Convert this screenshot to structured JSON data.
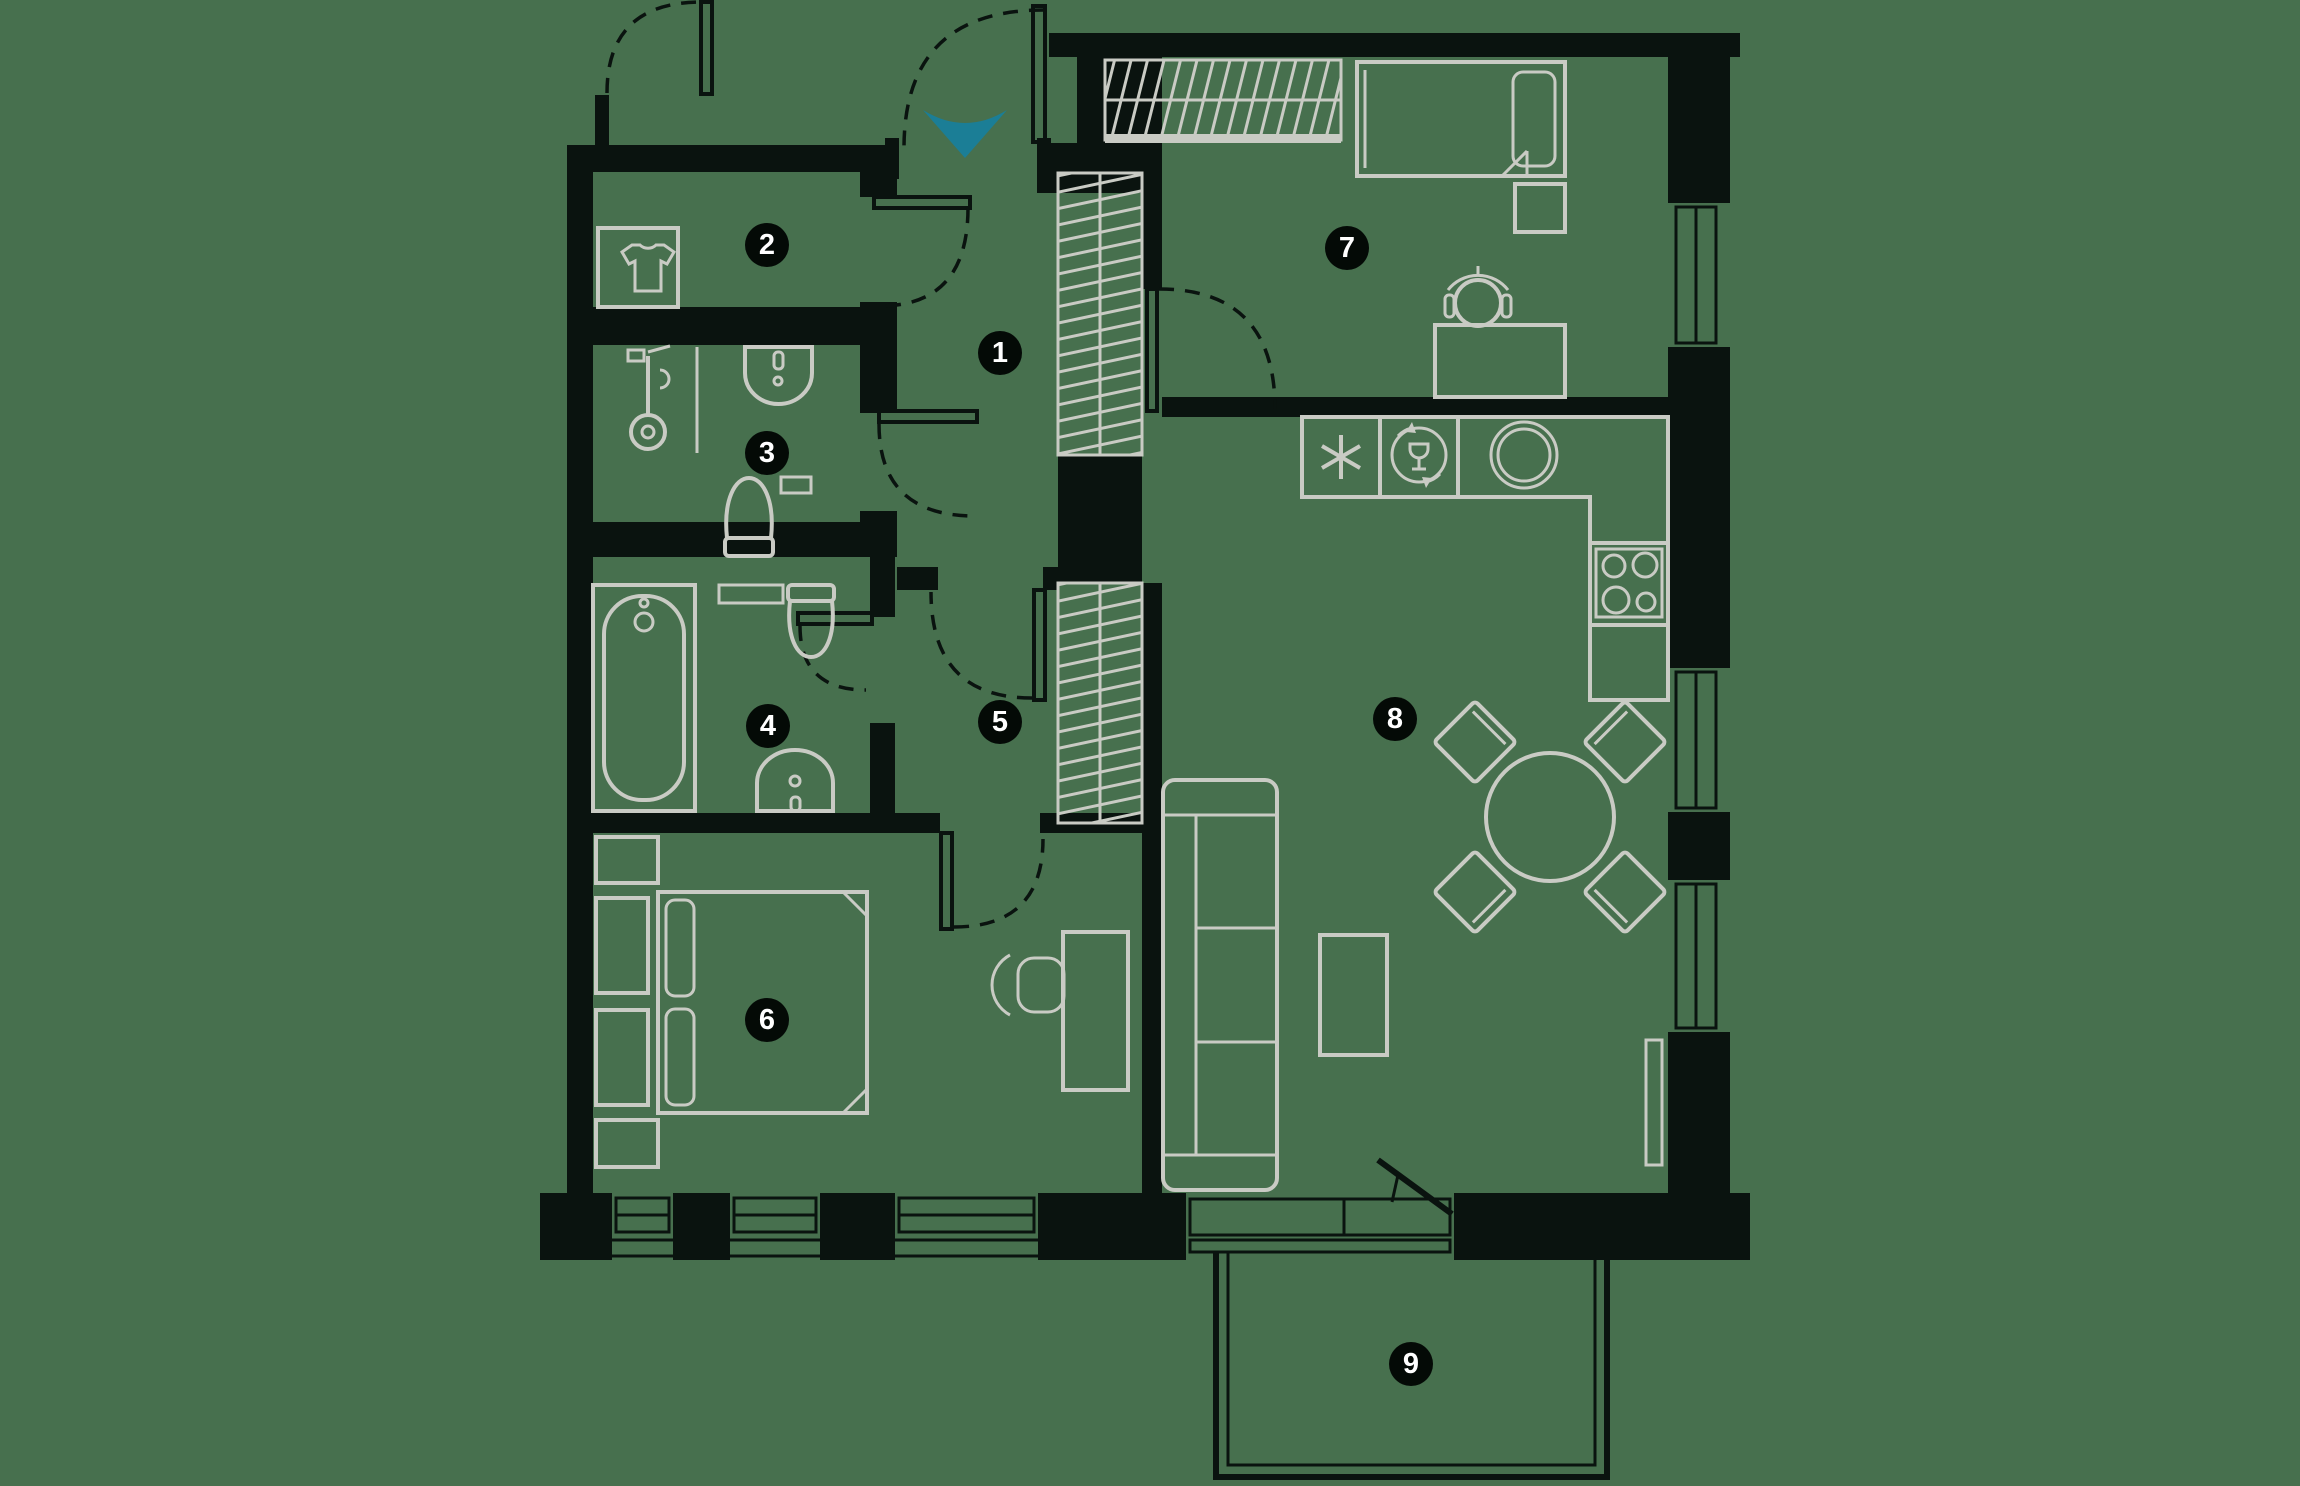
{
  "title": "apartment-floor-plan",
  "colors": {
    "bg": "#47704E",
    "wall": "#0A130F",
    "line": "#C9CBC4",
    "accent": "#1B7E96",
    "badge-bg": "#040A06",
    "badge-text": "#FFFFFF"
  },
  "rooms": {
    "r1": {
      "number": "1"
    },
    "r2": {
      "number": "2"
    },
    "r3": {
      "number": "3"
    },
    "r4": {
      "number": "4"
    },
    "r5": {
      "number": "5"
    },
    "r6": {
      "number": "6"
    },
    "r7": {
      "number": "7"
    },
    "r8": {
      "number": "8"
    },
    "r9": {
      "number": "9"
    }
  }
}
